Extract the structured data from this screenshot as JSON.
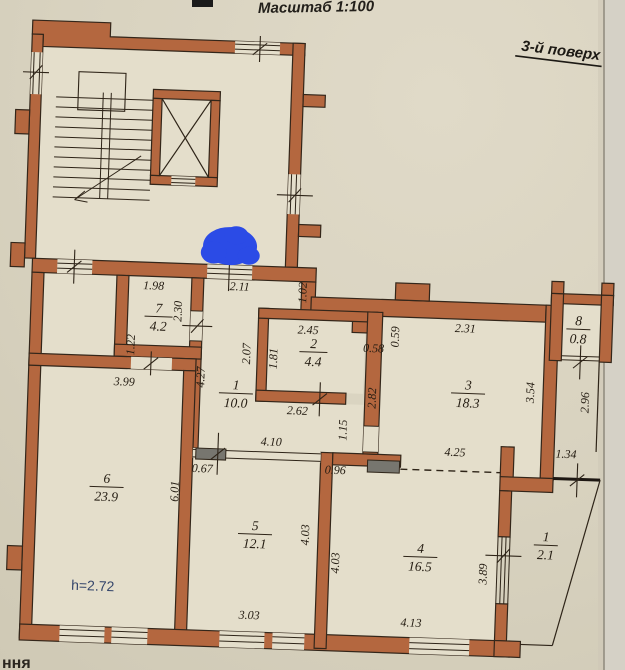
{
  "header": {
    "scale_label": "Масштаб 1:100",
    "floor_label": "3-й поверх"
  },
  "notes": {
    "ceiling_height": "h=2.72",
    "bottom_text_fragment": "ння"
  },
  "rooms": [
    {
      "num": "1",
      "area": "10.0"
    },
    {
      "num": "2",
      "area": "4.4"
    },
    {
      "num": "3",
      "area": "18.3"
    },
    {
      "num": "4",
      "area": "16.5"
    },
    {
      "num": "5",
      "area": "12.1"
    },
    {
      "num": "6",
      "area": "23.9"
    },
    {
      "num": "7",
      "area": "4.2"
    },
    {
      "num": "8",
      "area": "0.8"
    },
    {
      "num": "1",
      "area": "2.1"
    }
  ],
  "dims": {
    "d198": "1.98",
    "d211": "2.11",
    "d102": "1.02",
    "d230": "2.30",
    "d122": "1.22",
    "d399": "3.99",
    "d427": "4.27",
    "d207": "2.07",
    "d245": "2.45",
    "d181": "1.81",
    "d058": "0.58",
    "d059": "0.59",
    "d231": "2.31",
    "d354": "3.54",
    "d296": "2.96",
    "d262": "2.62",
    "d282": "2.82",
    "d115": "1.15",
    "d410": "4.10",
    "d067": "0.67",
    "d096": "0.96",
    "d425": "4.25",
    "d134": "1.34",
    "d601": "6.01",
    "d403a": "4.03",
    "d403b": "4.03",
    "d303": "3.03",
    "d413": "4.13",
    "d389": "3.89"
  },
  "colors": {
    "wall": "#b4673f",
    "paper": "#d8d2bf",
    "interior": "#e4decb",
    "line": "#33261a",
    "marker_blue": "#2b4be6",
    "height_note_color": "#35466b"
  }
}
